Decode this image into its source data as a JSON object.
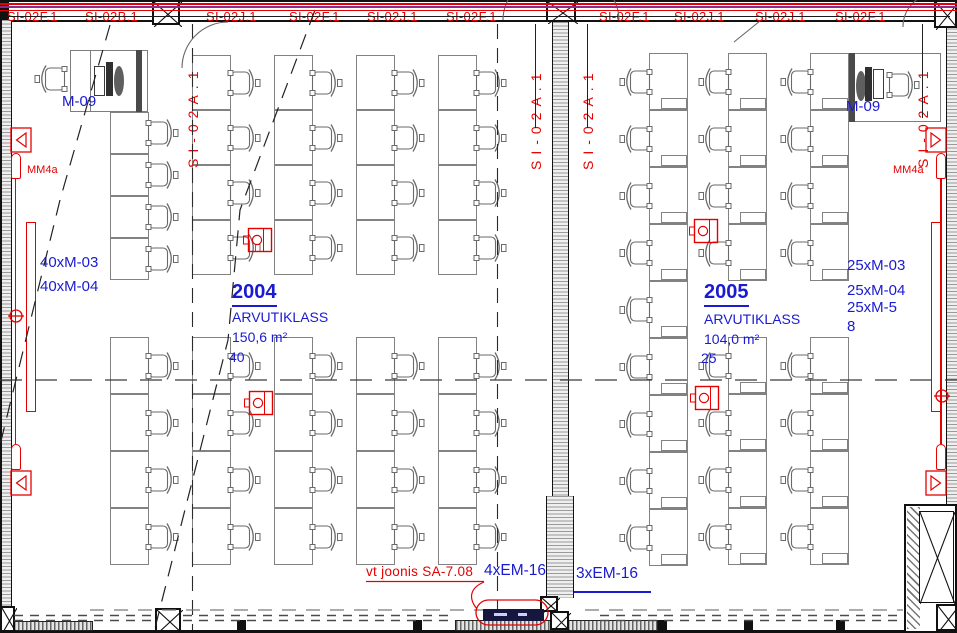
{
  "plan": {
    "cable_tray_labels_top": [
      "SI-02F.1",
      "SI-02B.1",
      "SI-02J.1",
      "SI-02F.1",
      "SI-02J.1",
      "SI-02F.1",
      "SI-02F.1",
      "SI-02J.1",
      "SI-02J.1",
      "SI-02F.1"
    ],
    "cable_tray_labels_vertical": [
      "SI-02A.1",
      "SI-02A.1",
      "SI-02A.1",
      "SI-02A.1"
    ],
    "rooms": [
      {
        "number": "2004",
        "type": "ARVUTIKLASS",
        "area": "150,6 m²",
        "workplaces": "40",
        "equipment": [
          "40xM-03",
          "40xM-04"
        ],
        "teacher_unit": "M-09",
        "speaker_circuit": "MM4a"
      },
      {
        "number": "2005",
        "type": "ARVUTIKLASS",
        "area": "104,0 m²",
        "workplaces": "25",
        "equipment": [
          "25xM-03",
          "25xM-04",
          "25xM-5",
          "8"
        ],
        "teacher_unit": "M-09",
        "speaker_circuit": "MM4a"
      }
    ],
    "notes": {
      "reference": "vt joonis SA-7.08",
      "trunking_a": "4xEM-16",
      "trunking_b": "3xEM-16"
    },
    "colors": {
      "annotation_red": "#e60000",
      "annotation_blue": "#1a1ad2",
      "pipe_purple": "#8a2b8f"
    }
  }
}
